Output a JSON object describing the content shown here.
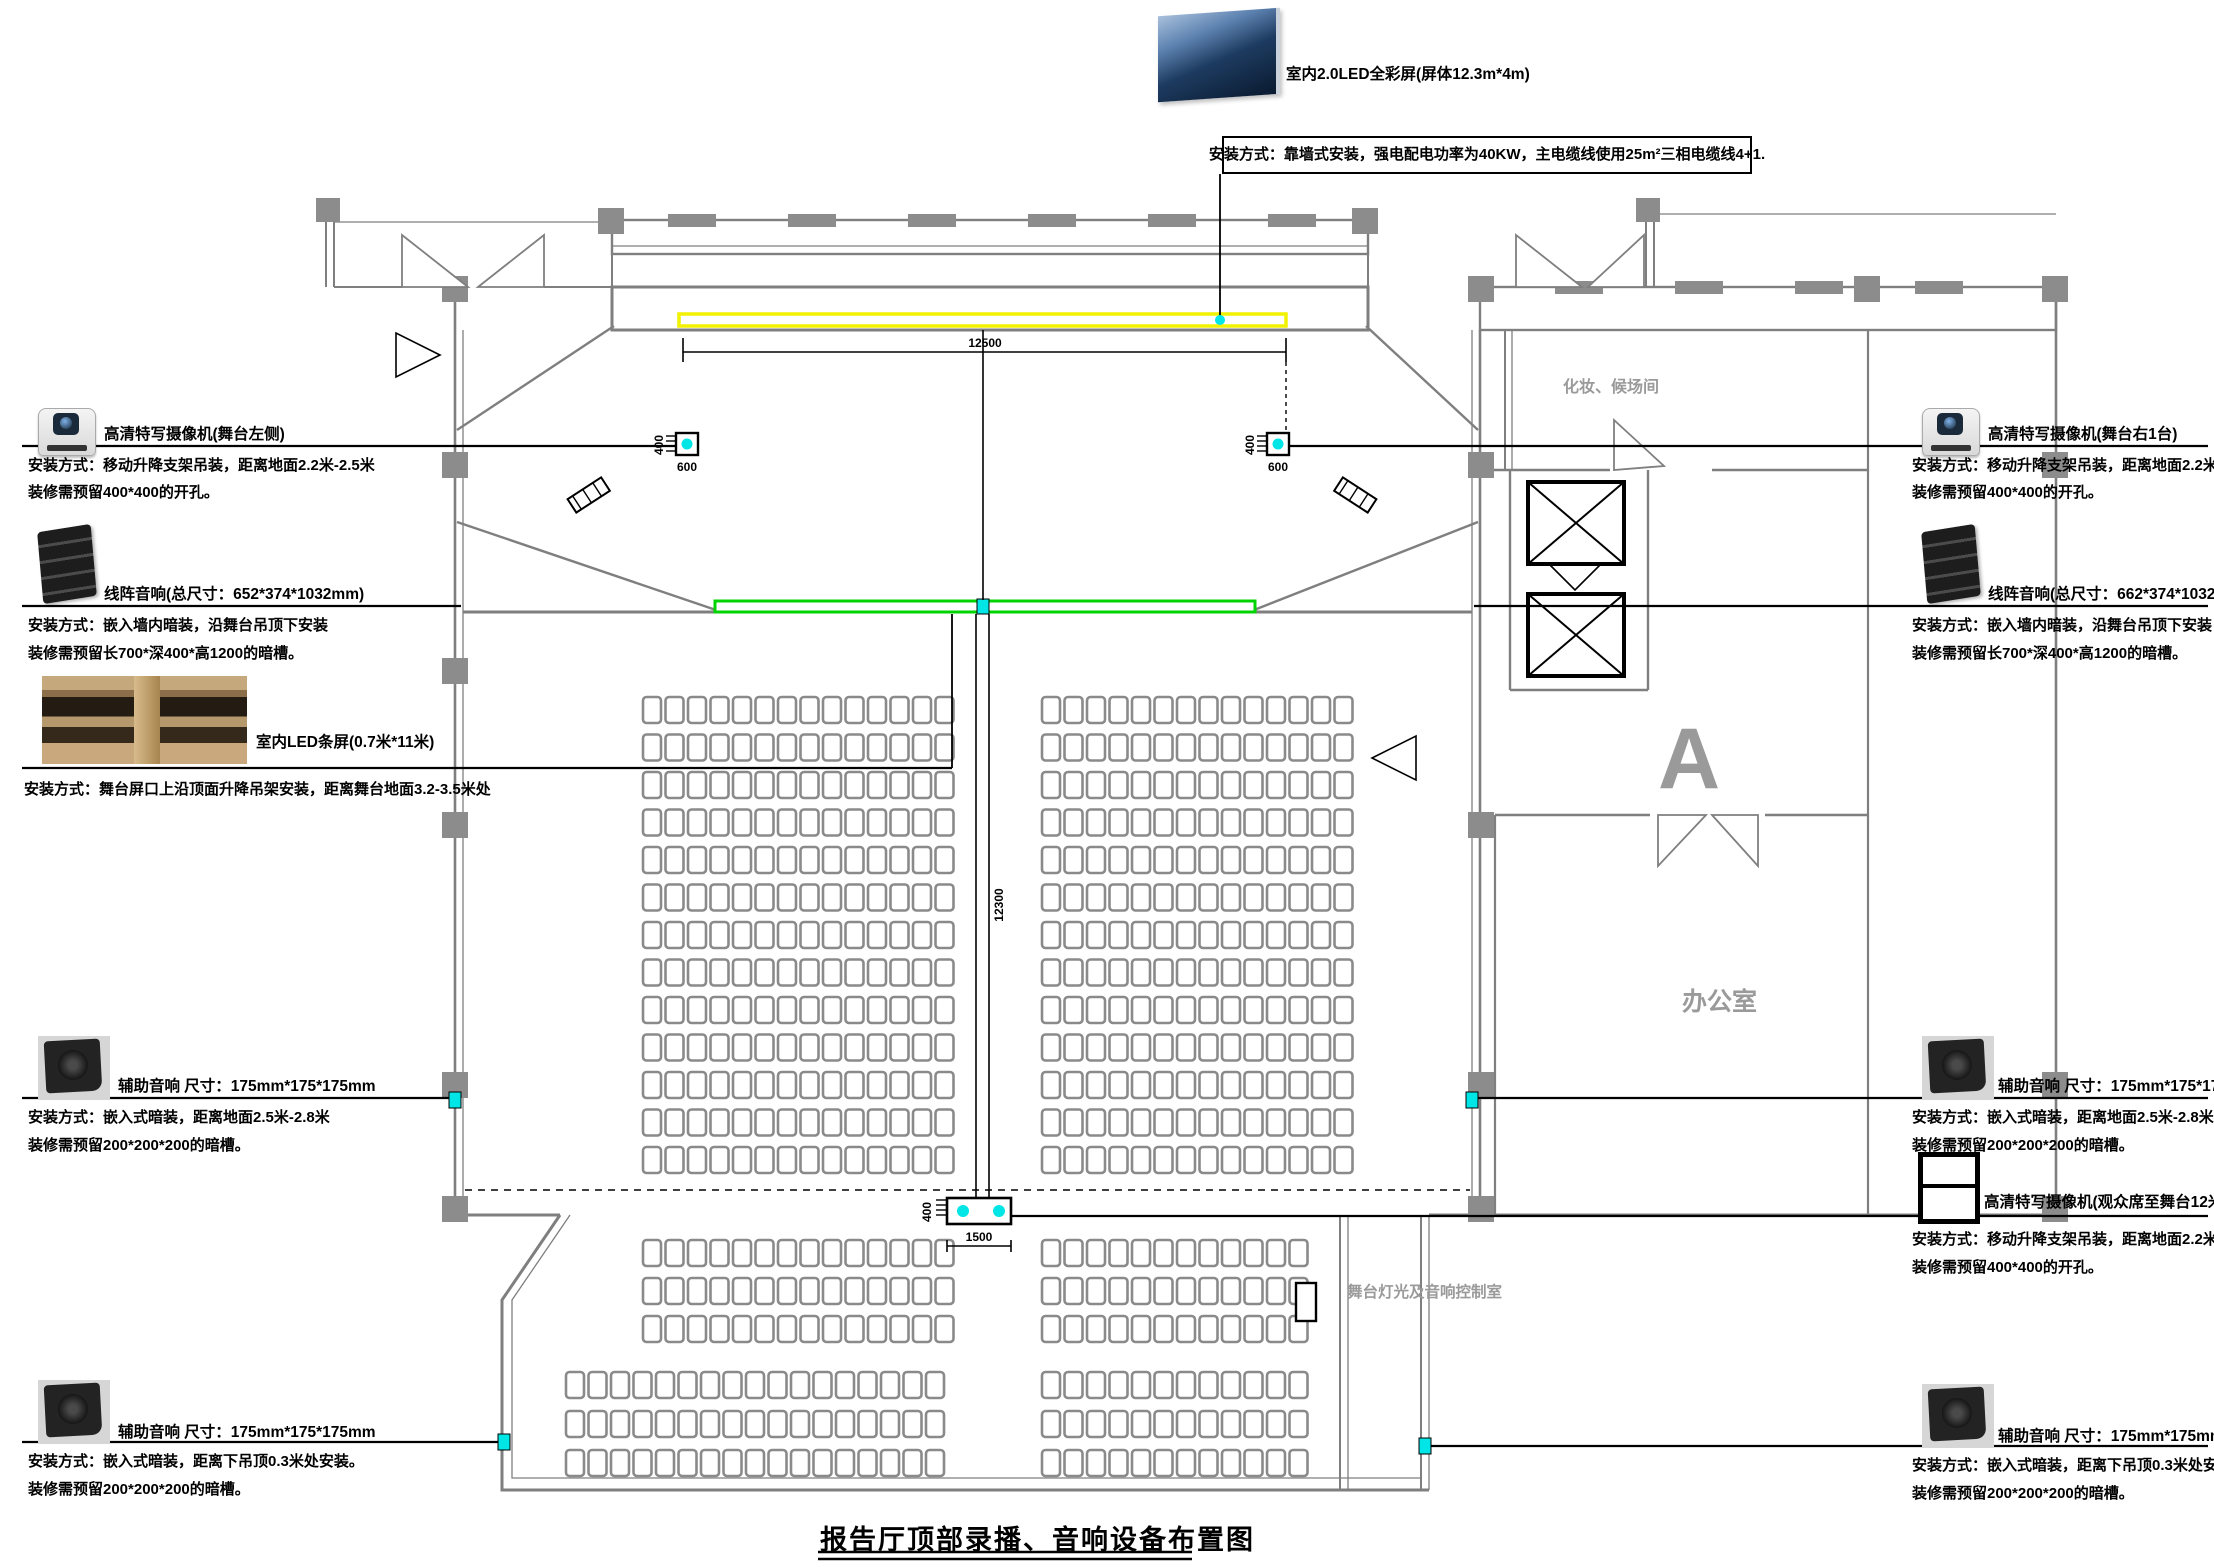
{
  "title": "报告厅顶部录播、音响设备布置图",
  "colors": {
    "wall": "#7f7f7f",
    "screen_yellow": "#f2f200",
    "led_green": "#00d400",
    "device_cyan": "#00e5e5"
  },
  "screen": {
    "label": "室内2.0LED全彩屏(屏体12.3m*4m)",
    "install": "安装方式：靠墙式安装，强电配电功率为40KW，主电缆线使用25m²三相电缆线4+1."
  },
  "annotations": {
    "left": [
      {
        "icon": "ptz-camera",
        "title": "高清特写摄像机(舞台左侧)",
        "lines": [
          "安装方式：移动升降支架吊装，距离地面2.2米-2.5米",
          "装修需预留400*400的开孔。"
        ]
      },
      {
        "icon": "line-array",
        "title": "线阵音响(总尺寸：652*374*1032mm)",
        "lines": [
          "安装方式：嵌入墙内暗装，沿舞台吊顶下安装",
          "装修需预留长700*深400*高1200的暗槽。"
        ]
      },
      {
        "icon": "led-strip-photo",
        "title": "室内LED条屏(0.7米*11米)",
        "lines": [
          "安装方式：舞台屏口上沿顶面升降吊架安装，距离舞台地面3.2-3.5米处"
        ]
      },
      {
        "icon": "aux-speaker",
        "title": "辅助音响 尺寸：175mm*175*175mm",
        "lines": [
          "安装方式：嵌入式暗装，距离地面2.5米-2.8米",
          "装修需预留200*200*200的暗槽。"
        ]
      },
      {
        "icon": "aux-speaker",
        "title": "辅助音响 尺寸：175mm*175*175mm",
        "lines": [
          "安装方式：嵌入式暗装，距离下吊顶0.3米处安装。",
          "装修需预留200*200*200的暗槽。"
        ]
      }
    ],
    "right": [
      {
        "icon": "ptz-camera",
        "title": "高清特写摄像机(舞台右1台)",
        "lines": [
          "安装方式：移动升降支架吊装，距离地面2.2米-2.5米",
          "装修需预留400*400的开孔。"
        ]
      },
      {
        "icon": "line-array",
        "title": "线阵音响(总尺寸：662*374*1032mm)",
        "lines": [
          "安装方式：嵌入墙内暗装，沿舞台吊顶下安装",
          "装修需预留长700*深400*高1200的暗槽。"
        ]
      },
      {
        "icon": "aux-speaker",
        "title": "辅助音响 尺寸：175mm*175*175mm",
        "lines": [
          "安装方式：嵌入式暗装，距离地面2.5米-2.8米",
          "装修需预留200*200*200的暗槽。"
        ]
      },
      {
        "icon": "camera-frame",
        "title": "高清特写摄像机(观众席至舞台12米处2台)",
        "lines": [
          "安装方式：移动升降支架吊装，距离地面2.2米-2.5米",
          "装修需预留400*400的开孔。"
        ]
      },
      {
        "icon": "aux-speaker",
        "title": "辅助音响 尺寸：175mm*175mm",
        "lines": [
          "安装方式：嵌入式暗装，距离下吊顶0.3米处安装",
          "装修需预留200*200*200的暗槽。"
        ]
      }
    ]
  },
  "rooms": {
    "dressing": "化妆、候场间",
    "office": "办公室",
    "control": "舞台灯光及音响控制室"
  },
  "dims": {
    "stage_width": "12500",
    "hall_depth": "12300",
    "cam_gap": "1500",
    "opening": "400",
    "offset": "600"
  },
  "marker_letter": "A",
  "seating": {
    "pitch": 22.5,
    "seat_w": 18,
    "seat_h": 26,
    "sections": [
      {
        "y0": 697,
        "dy": 37.5,
        "rows": 13,
        "blocks": [
          [
            643,
            958
          ],
          [
            1042,
            1357
          ]
        ]
      },
      {
        "y0": 1240,
        "dy": 38,
        "rows": 3,
        "blocks": [
          [
            643,
            958
          ],
          [
            1042,
            1330
          ]
        ]
      },
      {
        "y0": 1372,
        "dy": 39,
        "rows": 3,
        "blocks": [
          [
            566,
            958
          ],
          [
            1042,
            1330
          ]
        ]
      }
    ]
  }
}
